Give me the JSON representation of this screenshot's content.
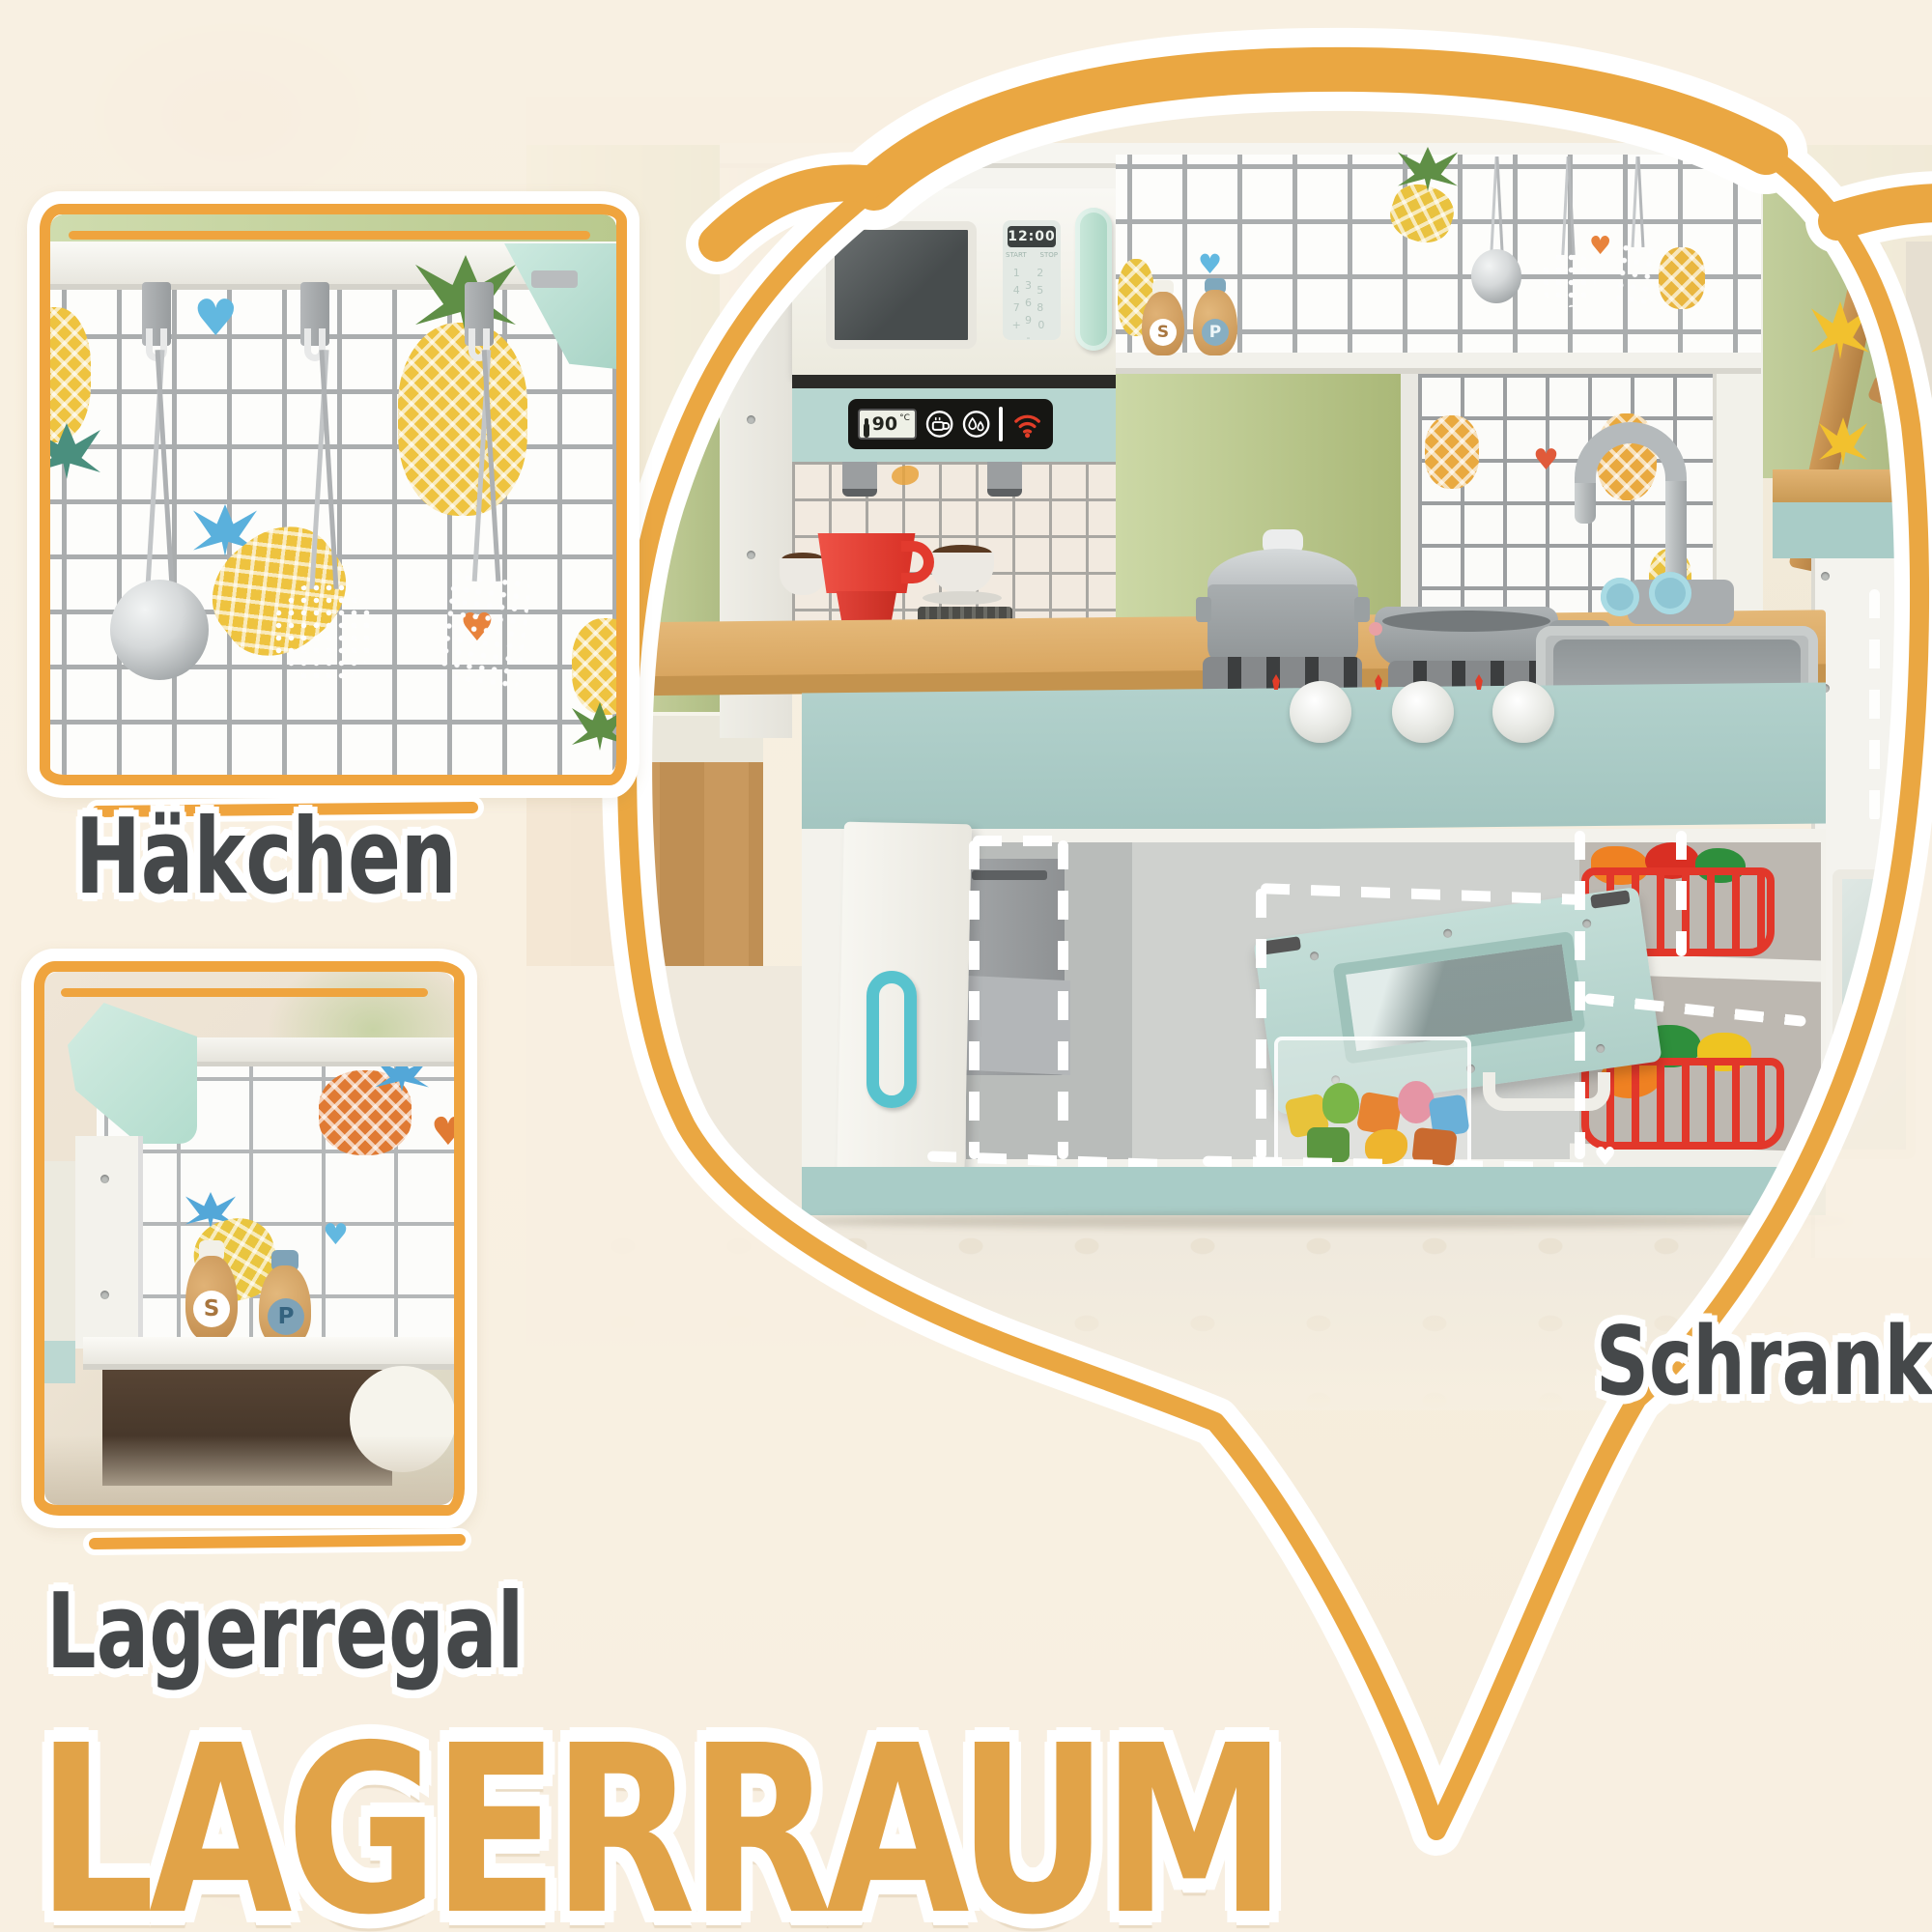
{
  "callouts": {
    "hooks_label": "Häkchen",
    "shelf_label": "Lagerregal",
    "cabinet_label": "Schrank",
    "heading": "LAGERRAUM"
  },
  "kitchen": {
    "microwave": {
      "time": "12:00",
      "start_button": "START",
      "stop_button": "STOP",
      "keypad_row1": "1 2 3",
      "keypad_row2": "4 5 6",
      "keypad_row3": "7 8 9",
      "keypad_row4": "+ 0 -"
    },
    "control_panel": {
      "temperature": "90",
      "unit": "°C"
    },
    "salt_shaker_letter": "S",
    "pepper_shaker_letter": "P"
  },
  "inset_shelf": {
    "salt_shaker_letter": "S",
    "pepper_shaker_letter": "P"
  },
  "colors": {
    "accent": "#eaa742",
    "heading": "#e1a348",
    "label": "#45484a",
    "mint": "#bcd9d3",
    "apron_teal": "#a9ccc7",
    "counter_wood": "#dfb271",
    "wall_green": "#b9c78e",
    "cream": "#f7efe0",
    "alert_red": "#e23d28"
  }
}
